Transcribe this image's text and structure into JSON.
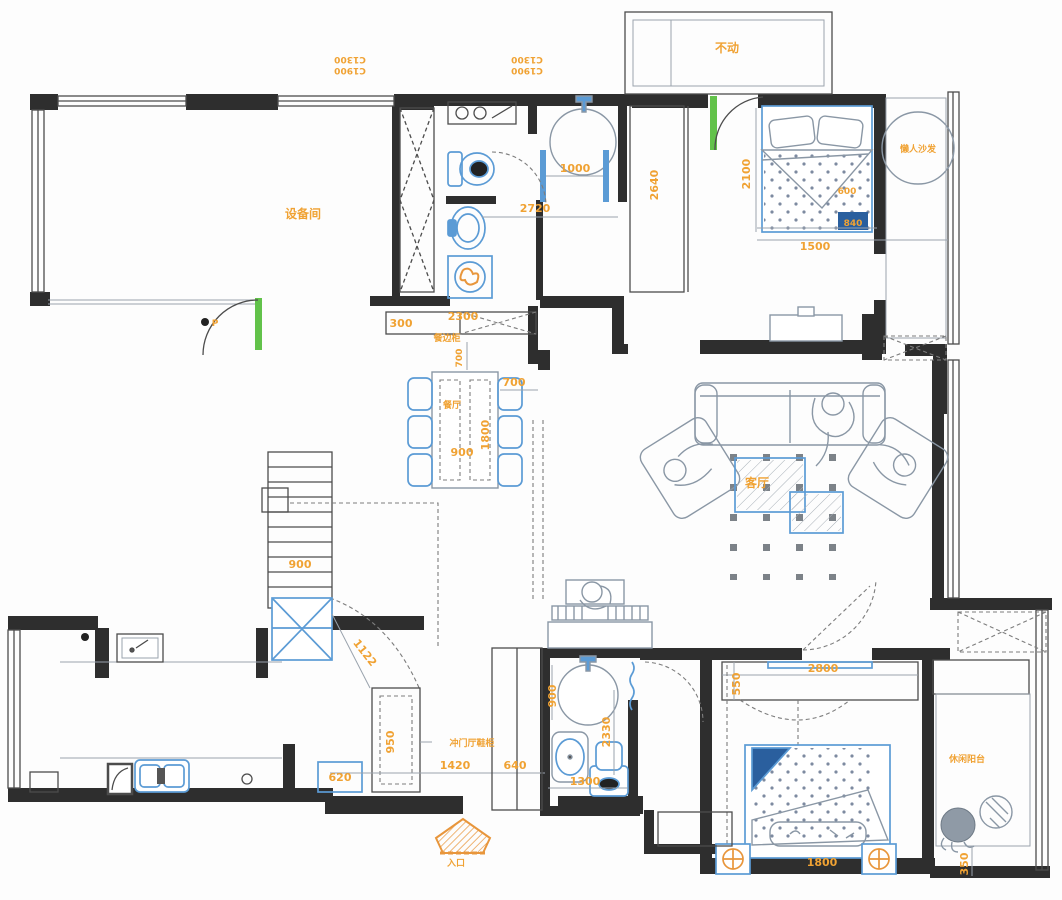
{
  "plan": {
    "type": "residential floor plan",
    "colors": {
      "wall": "#2e2e2e",
      "dimension_text": "#f0a233",
      "furniture_blue": "#5b9bd5",
      "new_wall_green": "#62c24a",
      "figure_gray": "#8a97a5"
    },
    "labels": {
      "window_tag_a1": "C1900",
      "window_tag_a2": "C1300",
      "equipment_room": "设备间",
      "keep_unchanged": "不动",
      "lazy_sofa": "懒人沙发",
      "sideboard": "餐边柜",
      "dining_room": "餐厅",
      "living_room": "客厅",
      "shoe_cabinet_note": "冲门厅鞋柜",
      "entrance": "入口",
      "leisure_balcony": "休闲阳台",
      "p_marker": "P"
    },
    "dims": {
      "d1000": "1000",
      "d2720": "2720",
      "d2640": "2640",
      "d2100": "2100",
      "d600": "600",
      "d840": "840",
      "d1500": "1500",
      "d300": "300",
      "d2300": "2300",
      "d700_side": "700",
      "d700_gap": "700",
      "d1800_table": "1800",
      "d900_table": "900",
      "d900_stairs": "900",
      "d1122": "1122",
      "d950": "950",
      "d620": "620",
      "d1420": "1420",
      "d640": "640",
      "d900_bath": "900",
      "d2330": "2330",
      "d1300": "1300",
      "d550": "550",
      "d2800": "2800",
      "d1800_bed": "1800",
      "d350": "350"
    }
  }
}
